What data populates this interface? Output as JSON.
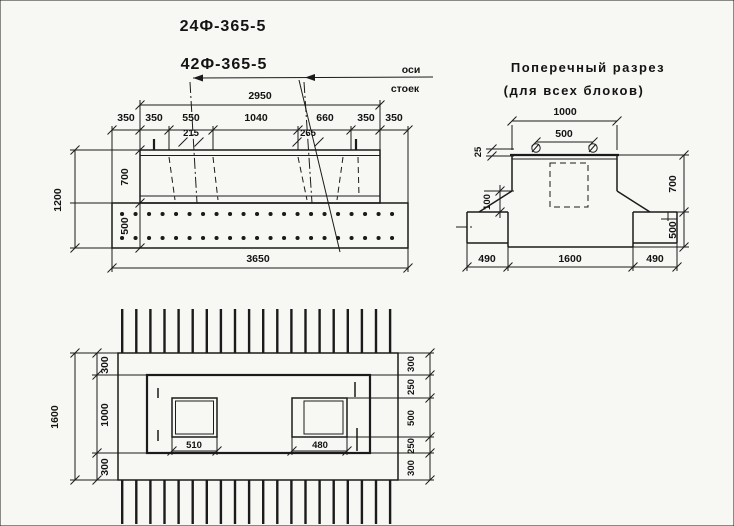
{
  "sheet": {
    "paper_color": "#f7f7f4",
    "ink_color": "#1b1b1b"
  },
  "titles": {
    "block1": "24Ф-365-5",
    "block2": "42Ф-365-5"
  },
  "elevation": {
    "axes_label_line1": "оси",
    "axes_label_line2": "стоек",
    "dim_span_top": "2950",
    "dims_row": [
      "350",
      "350",
      "550",
      "1040",
      "660",
      "350",
      "350"
    ],
    "dim_socket1_top": "215",
    "dim_socket2_top": "265",
    "dim_height_total": "1200",
    "dim_height_pedestal": "700",
    "dim_height_slab": "500",
    "dim_length_total": "3650"
  },
  "cross_section": {
    "title_line1": "Поперечный разрез",
    "title_line2": "(для всех блоков)",
    "dim_top_width": "1000",
    "dim_loops": "500",
    "dim_lip": "25",
    "dim_ledge": "100",
    "dim_height_pedestal": "700",
    "dim_height_slab": "500",
    "dims_bottom": [
      "490",
      "1600",
      "490"
    ]
  },
  "plan": {
    "dim_width_total": "1600",
    "dims_left": [
      "300",
      "1000",
      "300"
    ],
    "dims_right": [
      "300",
      "250",
      "500",
      "250",
      "300"
    ],
    "dim_socket1": "510",
    "dim_socket2": "480"
  }
}
